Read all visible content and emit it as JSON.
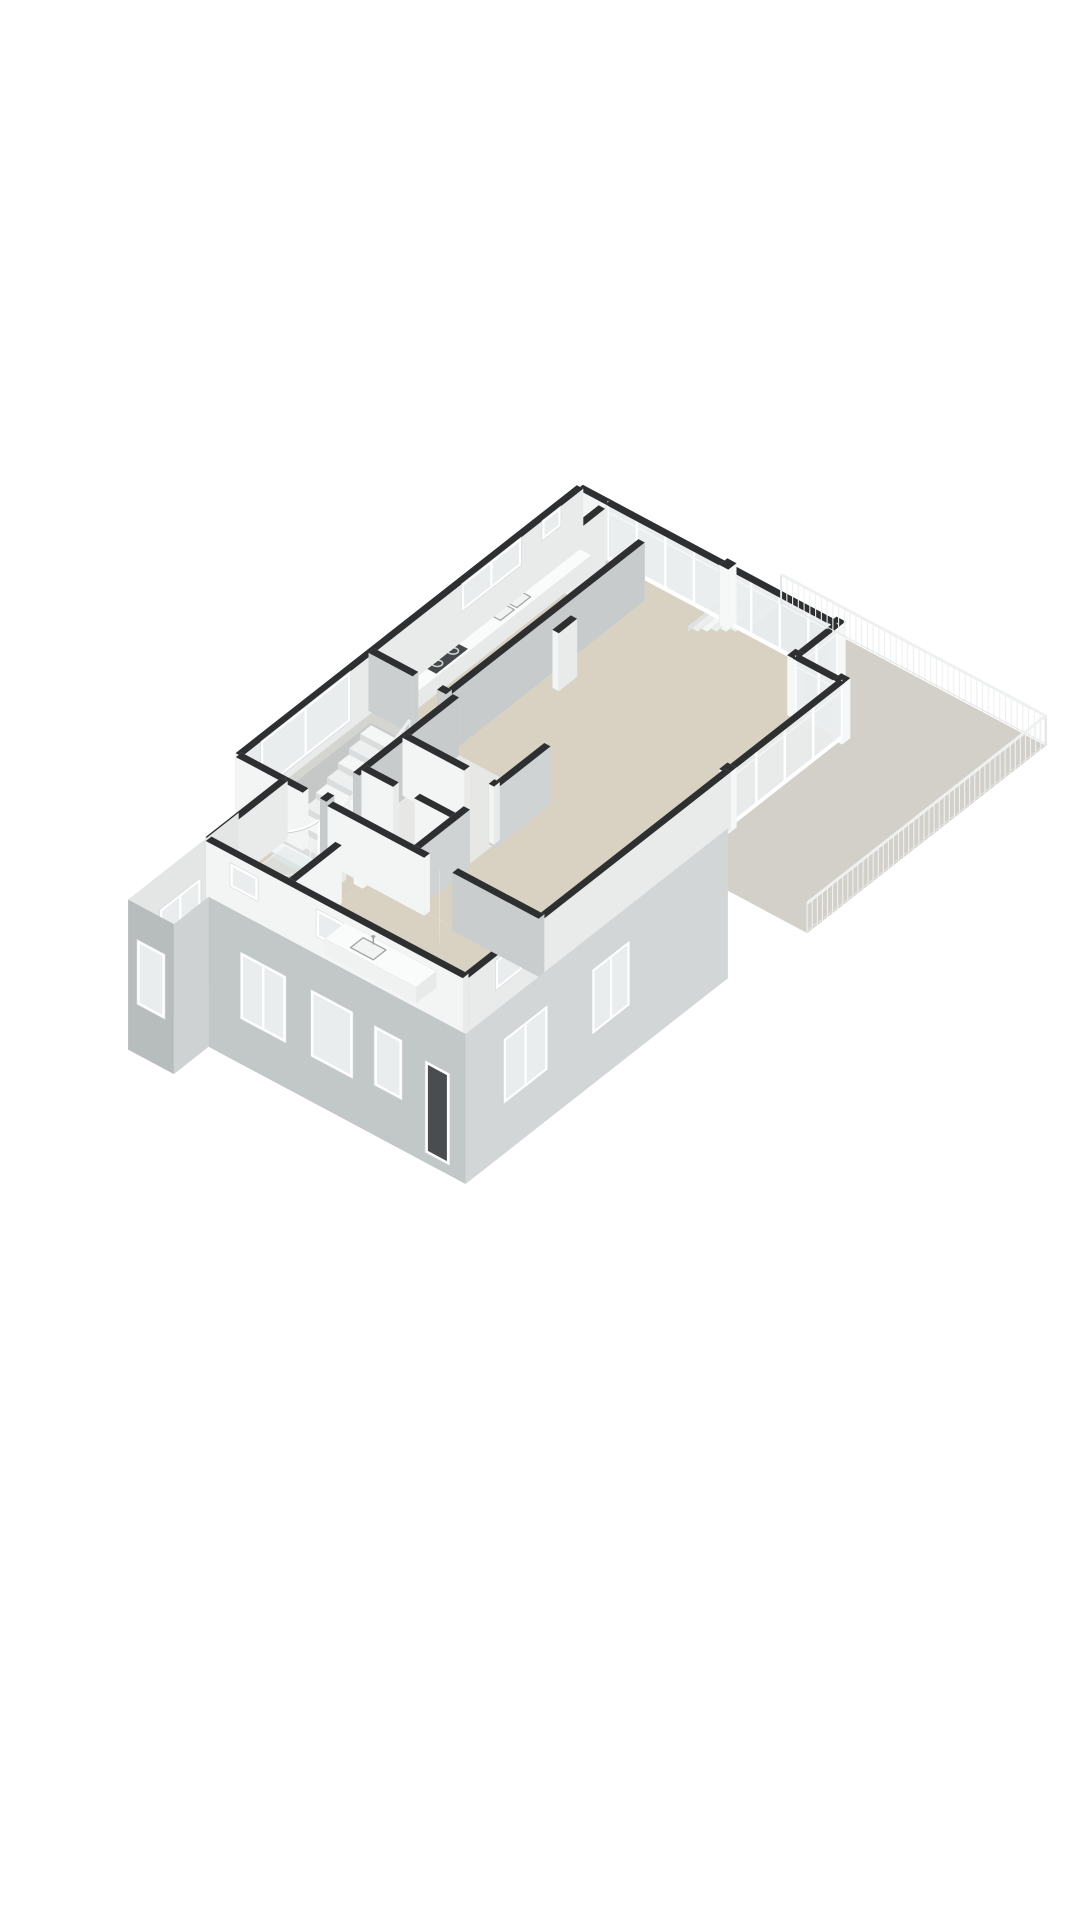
{
  "view": {
    "kind": "3d-floorplan-render",
    "background": "#ffffff",
    "width": 1080,
    "height": 1920
  },
  "scene": {
    "projection": {
      "ox": 580,
      "oy": 545,
      "k": 40,
      "ev": [
        0.88,
        0.47
      ],
      "eu": [
        -0.79,
        0.62
      ],
      "wallH": 58,
      "wallT": 0.18,
      "plinthH": 150
    },
    "palette": {
      "wallTop": "#2d2f30",
      "wallWhite": "#f3f4f4",
      "wallLight": "#e9ebeb",
      "wallMid": "#cfd3d3",
      "wallGray": "#c0c5c6",
      "wallDark": "#aab0b1",
      "floorBeige": "#d9d2c3",
      "floorHall": "#d4d5d1",
      "floorPale": "#e7e8e5",
      "floorTerrace": "#d2d0c8",
      "stairHole": "#c6c8c7",
      "glass": "#e9edee",
      "glassFrame": "#ffffff",
      "railing": "#eff1f1",
      "railingSoft": "#e2e5e5",
      "plinthLight": "#e4e6e6",
      "plinthMid": "#c2c7c7",
      "plinthDark": "#b7bcbc",
      "plinthFace": "#d3d6d6",
      "fixtureWhite": "#fafbfb",
      "fixtureShade": "#e8eaea",
      "stoveDark": "#45484a",
      "paneDark": "#4a4d4f",
      "trayStroke": "#c9cdcd"
    },
    "floors": [
      {
        "name": "terrace-floor",
        "color": "#d2d0c8",
        "pts": [
          [
            4.4,
            -1.15
          ],
          [
            12.2,
            -1.15
          ],
          [
            12.2,
            6.4
          ],
          [
            8.6,
            6.4
          ],
          [
            8.6,
            1.3
          ],
          [
            7.3,
            1.3
          ],
          [
            7.3,
            0
          ],
          [
            4.4,
            0
          ]
        ]
      },
      {
        "name": "kitchen-floor",
        "color": "#d9d2c3",
        "pts": [
          [
            0,
            0
          ],
          [
            2.2,
            0
          ],
          [
            2.2,
            6.6
          ],
          [
            0,
            6.6
          ]
        ]
      },
      {
        "name": "hall-floor",
        "color": "#d4d5d1",
        "pts": [
          [
            0,
            6.6
          ],
          [
            2.4,
            6.6
          ],
          [
            2.4,
            10.8
          ],
          [
            0,
            10.8
          ]
        ]
      },
      {
        "name": "middle-rooms-floor",
        "color": "#e7e8e5",
        "pts": [
          [
            2.4,
            6.6
          ],
          [
            5.0,
            6.6
          ],
          [
            5.0,
            10.8
          ],
          [
            2.4,
            10.8
          ]
        ]
      },
      {
        "name": "living-room-floor",
        "color": "#d9d2c3",
        "pts": [
          [
            2.2,
            0
          ],
          [
            7.3,
            0
          ],
          [
            7.3,
            1.3
          ],
          [
            8.6,
            1.3
          ],
          [
            8.6,
            10.8
          ],
          [
            5.0,
            10.8
          ],
          [
            5.0,
            6.6
          ],
          [
            2.2,
            6.6
          ]
        ]
      },
      {
        "name": "bathroom-floor",
        "color": "#d8d1c3",
        "pts": [
          [
            1.3,
            10.8
          ],
          [
            3.6,
            10.8
          ],
          [
            3.6,
            13.2
          ],
          [
            1.3,
            13.2
          ]
        ]
      },
      {
        "name": "bedroom-floor",
        "color": "#d9d2c3",
        "pts": [
          [
            3.6,
            10.8
          ],
          [
            8.6,
            10.8
          ],
          [
            8.6,
            13.2
          ],
          [
            3.6,
            13.2
          ]
        ]
      }
    ],
    "walls": [
      {
        "name": "nw-facade-wall",
        "a": [
          0,
          0
        ],
        "b": [
          0,
          10.8
        ],
        "windows": [
          {
            "s0": 0.5,
            "s1": 1.1,
            "z0": 34,
            "z1": 54
          },
          {
            "s0": 1.75,
            "s1": 3.65,
            "z0": 26,
            "z1": 54
          },
          {
            "s0": 7.15,
            "s1": 10.0,
            "z0": 4,
            "z1": 54
          }
        ]
      },
      {
        "name": "ne-solid-stub",
        "a": [
          0,
          0
        ],
        "b": [
          0.8,
          0
        ]
      },
      {
        "name": "apex-closet-wall",
        "a": [
          0.8,
          0.2
        ],
        "b": [
          0.8,
          1.35
        ]
      },
      {
        "name": "kitchen-living-wall",
        "a": [
          2.2,
          0.5
        ],
        "b": [
          2.2,
          6.6
        ],
        "cNear": "#c7cbcb"
      },
      {
        "name": "free-standing-pillar",
        "a": [
          2.7,
          3.2
        ],
        "b": [
          2.7,
          3.78
        ]
      },
      {
        "name": "hall-kitchen-wall-a",
        "a": [
          0,
          6.6
        ],
        "b": [
          1.25,
          6.6
        ],
        "cNear": "#cbcfcf"
      },
      {
        "name": "hall-kitchen-wall-b",
        "a": [
          1.95,
          6.6
        ],
        "b": [
          2.2,
          6.6
        ],
        "cNear": "#cbcfcf"
      },
      {
        "name": "hall-living-wall-a",
        "a": [
          2.4,
          6.6
        ],
        "b": [
          2.4,
          9.75
        ],
        "cNear": "#c7cbcb"
      },
      {
        "name": "hall-living-wall-b",
        "a": [
          2.4,
          10.55
        ],
        "b": [
          2.4,
          10.8
        ],
        "cNear": "#c7cbcb"
      },
      {
        "name": "middle-living-wall-a",
        "a": [
          5.0,
          6.6
        ],
        "b": [
          5.0,
          8.35
        ],
        "cNear": "#cfd3d3"
      },
      {
        "name": "middle-living-wall-b",
        "a": [
          5.0,
          9.15
        ],
        "b": [
          5.0,
          10.8
        ],
        "cNear": "#cfd3d3"
      },
      {
        "name": "closet-divider-a",
        "a": [
          2.4,
          8.2
        ],
        "b": [
          4.15,
          8.2
        ]
      },
      {
        "name": "closet-divider-a2",
        "a": [
          4.85,
          8.2
        ],
        "b": [
          5.0,
          8.2
        ]
      },
      {
        "name": "closet-divider-b",
        "a": [
          2.4,
          9.5
        ],
        "b": [
          3.3,
          9.5
        ]
      },
      {
        "name": "closet-divider-b2",
        "a": [
          3.9,
          9.5
        ],
        "b": [
          5.0,
          9.5
        ]
      },
      {
        "name": "blockb-nw-wall-a",
        "a": [
          1.3,
          10.8
        ],
        "b": [
          1.9,
          10.8
        ],
        "cNear": "#f3f4f4"
      },
      {
        "name": "blockb-nw-wall-b",
        "a": [
          2.6,
          10.8
        ],
        "b": [
          5.35,
          10.8
        ],
        "cNear": "#f3f4f4"
      },
      {
        "name": "blockb-nw-wall-c",
        "a": [
          6.15,
          10.8
        ],
        "b": [
          8.6,
          10.8
        ],
        "cNear": "#c9cdcd"
      },
      {
        "name": "bath-bedroom-divider",
        "a": [
          3.6,
          11.65
        ],
        "b": [
          3.6,
          13.2
        ],
        "cNear": "#f3f4f4"
      },
      {
        "name": "west-step-wall",
        "a": [
          1.3,
          10.8
        ],
        "b": [
          1.3,
          13.2
        ],
        "cNear": "#e9ebeb"
      },
      {
        "name": "west-step-nw-wall",
        "a": [
          0,
          10.8
        ],
        "b": [
          1.3,
          10.8
        ]
      },
      {
        "name": "sw-facade-wall",
        "a": [
          1.3,
          13.2
        ],
        "b": [
          8.6,
          13.2
        ],
        "windows": [
          {
            "s0": 0.7,
            "s1": 1.5,
            "z0": 26,
            "z1": 50
          },
          {
            "s0": 3.15,
            "s1": 4.15,
            "z0": 22,
            "z1": 50
          },
          {
            "s0": 4.45,
            "s1": 5.45,
            "z0": 22,
            "z1": 50
          }
        ]
      },
      {
        "name": "se-facade-wall",
        "a": [
          8.6,
          4.9
        ],
        "b": [
          8.6,
          13.2
        ],
        "windows": [
          {
            "s0": 6.4,
            "s1": 7.25,
            "z0": 20,
            "z1": 50
          }
        ]
      }
    ],
    "glassWalls": [
      {
        "name": "ne-window-band",
        "a": [
          0.8,
          0
        ],
        "b": [
          7.3,
          0
        ],
        "mullions": 8
      },
      {
        "name": "bay-glass-a",
        "a": [
          7.3,
          0
        ],
        "b": [
          7.3,
          1.3
        ],
        "mullions": 2
      },
      {
        "name": "bay-glass-b",
        "a": [
          7.3,
          1.3
        ],
        "b": [
          8.6,
          1.3
        ],
        "mullions": 2
      },
      {
        "name": "bay-glass-c",
        "a": [
          8.6,
          1.3
        ],
        "b": [
          8.6,
          4.9
        ],
        "mullions": 4
      }
    ],
    "posts": [
      {
        "name": "glass-post-1",
        "at": [
          4.2,
          0
        ]
      },
      {
        "name": "glass-post-2",
        "at": [
          7.3,
          0
        ]
      },
      {
        "name": "glass-post-3",
        "at": [
          7.3,
          1.3
        ]
      },
      {
        "name": "glass-post-4",
        "at": [
          8.6,
          1.3
        ]
      },
      {
        "name": "glass-post-5",
        "at": [
          8.6,
          4.9
        ]
      },
      {
        "name": "door-post-1",
        "at": [
          3.6,
          10.9
        ]
      }
    ],
    "railing": {
      "name": "terrace-railing",
      "h": 30,
      "spacing": 0.16,
      "segments": [
        [
          [
            4.68,
            -1.15
          ],
          [
            12.2,
            -1.15
          ]
        ],
        [
          [
            12.2,
            -1.15
          ],
          [
            12.2,
            6.4
          ]
        ]
      ]
    },
    "extStairs": {
      "name": "terrace-exterior-stairs",
      "u0": -1.12,
      "u1": -0.08,
      "vStart": 4.62,
      "treadDepth": 0.27,
      "steps": 6,
      "drop": 5
    },
    "intStairs": {
      "name": "hall-staircase",
      "v0": 0.35,
      "v1": 1.45,
      "uStart": 7.0,
      "treadDepth": 0.35,
      "steps": 9,
      "drop": 6,
      "railH": 26
    },
    "plinthFaces": [
      {
        "name": "plinth-west-nw-face",
        "a": [
          0,
          10.8
        ],
        "b": [
          0,
          14.3
        ],
        "color": "#e4e6e6",
        "windows": [
          {
            "s0": 1.2,
            "s1": 2.5,
            "z0": -95,
            "z1": -35
          }
        ]
      },
      {
        "name": "plinth-west-sw-face",
        "a": [
          0,
          14.3
        ],
        "b": [
          1.3,
          14.3
        ],
        "color": "#b7bcbc",
        "windows": [
          {
            "s0": 0.25,
            "s1": 1.05,
            "z0": -100,
            "z1": -35
          }
        ]
      },
      {
        "name": "plinth-west-se-face",
        "a": [
          1.3,
          14.3
        ],
        "b": [
          1.3,
          13.2
        ],
        "color": "#cfd2d2",
        "windows": []
      },
      {
        "name": "plinth-sw-face",
        "a": [
          1.3,
          13.2
        ],
        "b": [
          8.6,
          13.2
        ],
        "color": "#c2c7c7",
        "windows": [
          {
            "s0": 0.9,
            "s1": 2.2,
            "z0": -105,
            "z1": -38
          },
          {
            "s0": 2.9,
            "s1": 4.1,
            "z0": -105,
            "z1": -38
          },
          {
            "s0": 4.7,
            "s1": 5.5,
            "z0": -100,
            "z1": -40
          },
          {
            "s0": 6.15,
            "s1": 6.85,
            "z0": -140,
            "z1": -48,
            "dark": true
          }
        ]
      },
      {
        "name": "plinth-se-face",
        "a": [
          8.6,
          13.2
        ],
        "b": [
          8.6,
          4.9
        ],
        "color": "#d3d6d6",
        "windows": [
          {
            "s0": 1.2,
            "s1": 2.6,
            "z0": -100,
            "z1": -35
          },
          {
            "s0": 4.0,
            "s1": 5.2,
            "z0": -100,
            "z1": -35
          }
        ]
      }
    ],
    "fixtures": {
      "kitchenCounter": {
        "name": "kitchen-counter",
        "v0": 0.12,
        "v1": 0.78,
        "u0": 0.5,
        "u1": 6.45,
        "h": 17
      },
      "stove": {
        "name": "stove-cooktop",
        "v0": 0.2,
        "v1": 0.72,
        "u0": 4.35,
        "u1": 5.35
      },
      "kitchenSink": {
        "name": "kitchen-sink",
        "v0": 0.2,
        "v1": 0.66,
        "u0": 2.3,
        "u1": 3.25
      },
      "vanity": {
        "name": "bedroom-vanity",
        "v0": 4.5,
        "v1": 7.1,
        "u0": 12.45,
        "u1": 13.1,
        "h": 16,
        "basin": {
          "v0": 5.15,
          "v1": 5.8,
          "u0": 12.6,
          "u1": 13.0
        }
      },
      "wcSink": {
        "name": "wc-hand-basin",
        "v0": 4.5,
        "v1": 4.95,
        "u0": 9.62,
        "u1": 10.02,
        "h": 13
      },
      "toilet": {
        "name": "toilet",
        "tank": {
          "v0": 2.55,
          "v1": 3.25,
          "u0": 11.02,
          "u1": 11.3,
          "h": 14
        },
        "bowl": {
          "c": [
            2.9,
            11.55
          ],
          "rx": 10,
          "ry": 7
        }
      },
      "shower": {
        "name": "corner-shower",
        "c": [
          1.5,
          11.0
        ],
        "r": 0.95,
        "h": 44
      },
      "bedroomDoor": {
        "name": "bedroom-door-leaf",
        "a": [
          5.75,
          10.85
        ],
        "b": [
          6.2,
          11.35
        ],
        "h": 52
      }
    }
  }
}
